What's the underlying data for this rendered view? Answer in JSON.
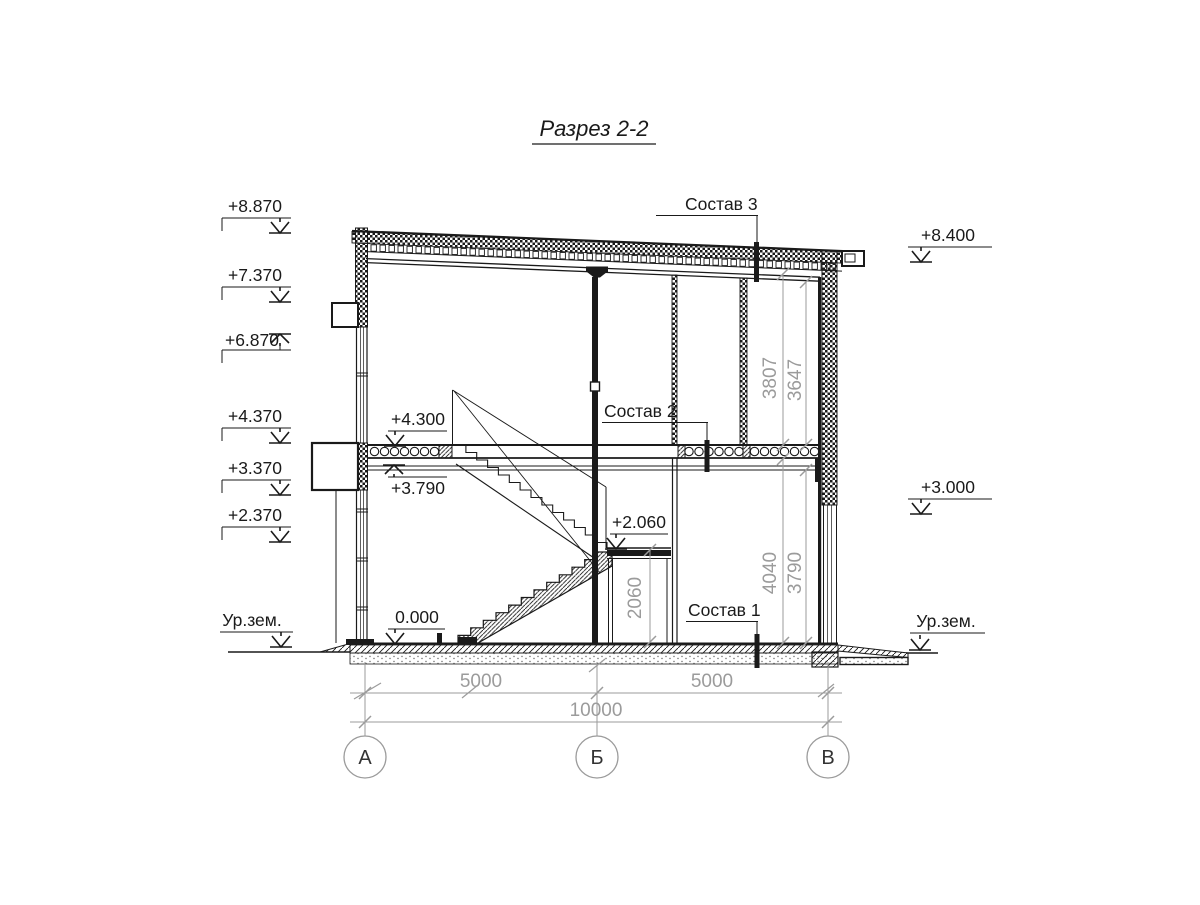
{
  "title": "Разрез 2-2",
  "marks": {
    "left": [
      "+8.870",
      "+7.370",
      "+6.870",
      "+4.370",
      "+3.370",
      "+2.370"
    ],
    "right": [
      "+8.400",
      "+3.000"
    ],
    "ground_left": "Ур.зем.",
    "ground_right": "Ур.зем.",
    "floor2": "+4.300",
    "ceiling1": "+3.790",
    "landing": "+2.060",
    "floor1": "0.000"
  },
  "callouts": {
    "roof": "Состав 3",
    "floor2": "Состав 2",
    "floor1": "Состав 1"
  },
  "dims": {
    "span1": "5000",
    "span2": "5000",
    "total": "10000",
    "room2_upper": "3807",
    "room2_lower": "3647",
    "room1_upper": "4040",
    "room1_lower": "3790",
    "under_landing": "2060"
  },
  "axes": [
    "А",
    "Б",
    "В"
  ],
  "colors": {
    "ink": "#1a1a1a",
    "dim": "#9b9b9b",
    "background": "#ffffff"
  }
}
